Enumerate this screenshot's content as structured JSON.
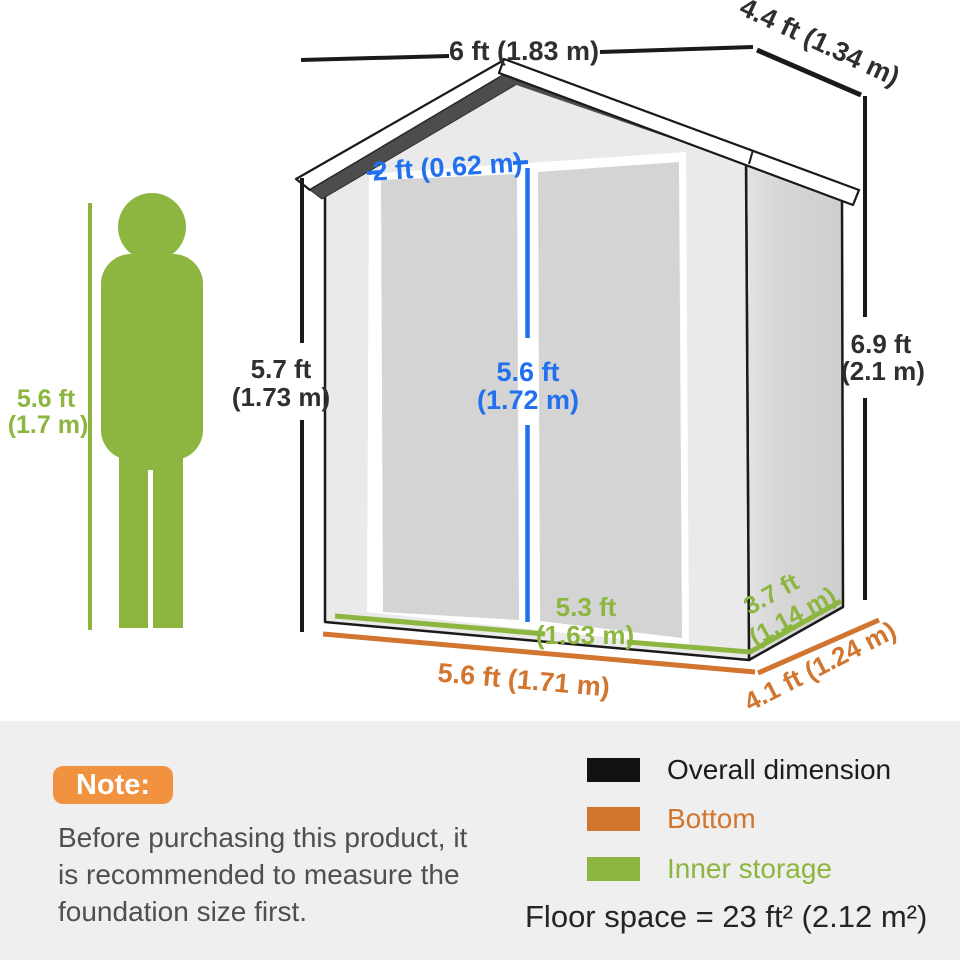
{
  "diagram": {
    "person": {
      "height_ft": "5.6 ft",
      "height_m": "(1.7 m)"
    },
    "dimensions": {
      "overall_width": "6 ft (1.83 m)",
      "overall_depth": "4.4 ft (1.34 m)",
      "front_height_ft": "5.7 ft",
      "front_height_m": "(1.73 m)",
      "peak_height_ft": "6.9 ft",
      "peak_height_m": "(2.1 m)",
      "door_width": "2 ft (0.62 m)",
      "door_height_ft": "5.6 ft",
      "door_height_m": "(1.72 m)",
      "inner_width_ft": "5.3 ft",
      "inner_width_m": "(1.63 m)",
      "inner_depth_ft": "3.7 ft",
      "inner_depth_m": "(1.14 m)",
      "bottom_width": "5.6 ft (1.71 m)",
      "bottom_depth": "4.1 ft (1.24 m)"
    },
    "colors": {
      "overall_dimension": "#121212",
      "bottom": "#d2752e",
      "inner_storage": "#8cb63f",
      "door_dimension": "#2170f0",
      "note_badge": "#f0923f"
    }
  },
  "note": {
    "label": "Note:",
    "lines": [
      "Before purchasing this product, it",
      "is recommended to measure the",
      "foundation size first."
    ]
  },
  "legend": {
    "items": [
      {
        "label": "Overall dimension",
        "color": "#121212"
      },
      {
        "label": "Bottom",
        "color": "#d2752e"
      },
      {
        "label": "Inner storage",
        "color": "#8cb63f"
      }
    ]
  },
  "floor_space": "Floor space = 23 ft² (2.12 m²)"
}
